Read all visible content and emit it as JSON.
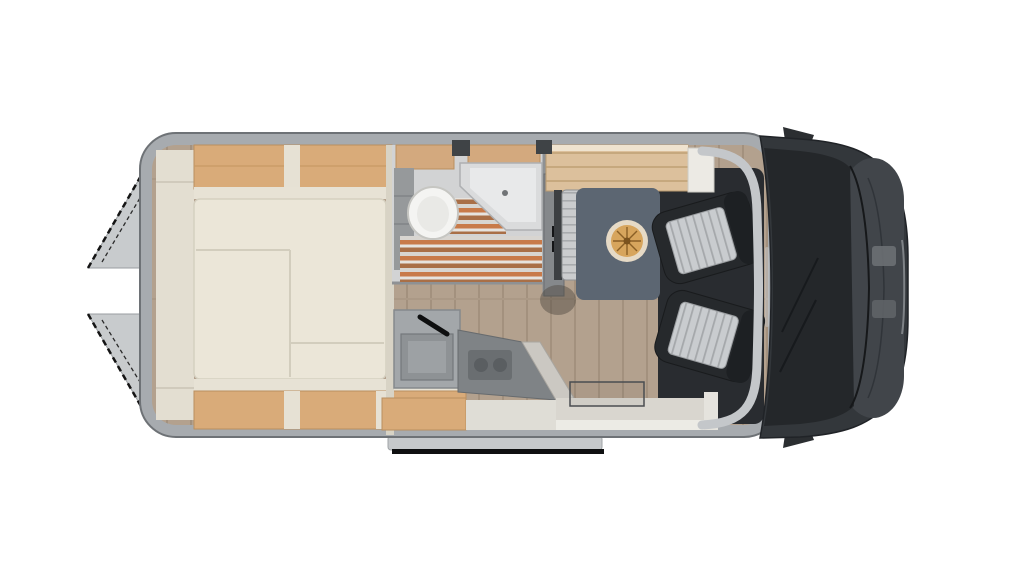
{
  "image": {
    "description": "Top-down floor plan of a campervan motorhome with rear bed, bathroom, kitchen, dinette and swivelled cab seats",
    "background": "#ffffff"
  },
  "palette": {
    "wall_gray": "#a7abaf",
    "wall_edge": "#6e7276",
    "floor_wood": "#b3a18e",
    "cabinet_wood": "#d9ab79",
    "bed_cream": "#ebe6d8",
    "trim_cream": "#e7e2d5",
    "bathroom_floor": "#d2d3d4",
    "shower_slat_orange": "#c87a49",
    "shower_slat_brown": "#a96f47",
    "rug_blue_gray": "#5c6672",
    "table_wood": "#d7a55d",
    "seat_cushion": "#c9cccf",
    "cab_dark": "#26292c",
    "vehicle_body": "#33373b",
    "windshield_glass": "#24272a",
    "step_black": "#0f1011",
    "door_gray": "#c8cbcd"
  },
  "labels": {
    "floorplan": "Campervan floor plan, top view",
    "rear_door_top": "Open rear door (upper)",
    "rear_door_bottom": "Open rear door (lower)",
    "side_step": "Entry step",
    "mirror_top": "Side mirror",
    "mirror_bottom": "Side mirror",
    "body": "Van body shell",
    "floor": "Wood-look floor",
    "shelf": "Rear side shelf",
    "overhead_rear": "Overhead cabinets above bed",
    "bed": "Transverse double bed",
    "under_bed": "Under-bed cabinets",
    "bathroom": "Bathroom compartment",
    "toilet": "Toilet",
    "sink": "Corner washbasin",
    "shower": "Shower slat grate",
    "vent": "Roof vent",
    "wardrobe": "Wardrobe with TV bracket",
    "sideboard": "Sideboard cabinet",
    "bench": "Dinette bench seat",
    "rug": "Lounge rug",
    "table": "Round dining table",
    "kitchen": "Kitchen block",
    "kitchen_sink": "Kitchen sink with faucet",
    "stove": "Hob / stove unit",
    "kitchen_cabinet": "Kitchen base cabinet",
    "entry": "Sliding-door entry floor",
    "entry_mat": "Entry mat",
    "cab_block": "Cab interior",
    "seat_top": "Swivelled cab seat (driver side)",
    "seat_bottom": "Swivelled cab seat (passenger side)",
    "windshield_frame": "Windscreen frame",
    "vehicle_front": "Vehicle front and bonnet",
    "windshield": "Windscreen",
    "hood": "Bonnet",
    "marking": "Windscreen marking"
  }
}
